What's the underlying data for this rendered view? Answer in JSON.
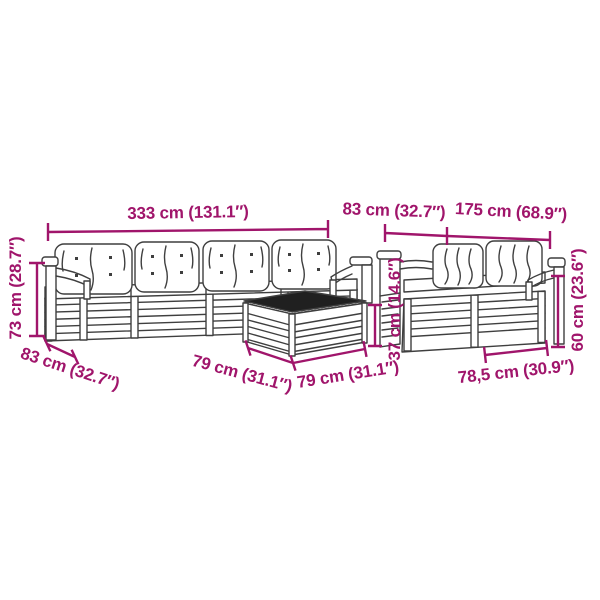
{
  "colors": {
    "dimension": "#A0156B",
    "furniture_line": "#3F3F3F",
    "table_top": "#202020",
    "background": "#FFFFFF"
  },
  "labels": {
    "total_width": "333 cm (131.1″)",
    "module_width": "83 cm (32.7″)",
    "right_sofa_width": "175 cm (68.9″)",
    "total_height": "73 cm (28.7″)",
    "seat_depth": "83 cm (32.7″)",
    "table_width": "79 cm (31.1″)",
    "table_depth": "79 cm (31.1″)",
    "table_height": "37 cm (14.6″)",
    "armrest_height": "60 cm (23.6″)",
    "right_module_width": "78,5 cm (30.9″)"
  }
}
